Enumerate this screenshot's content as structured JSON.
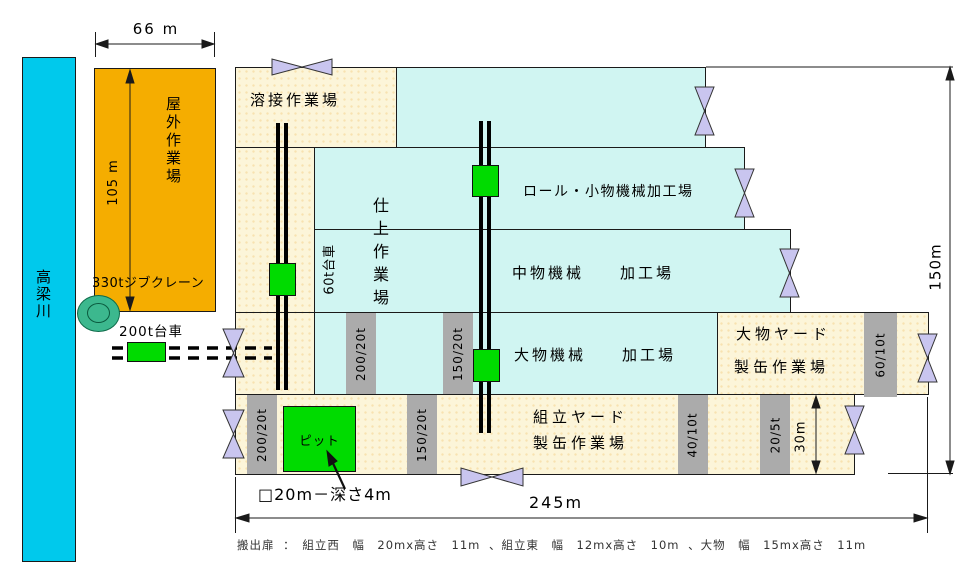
{
  "river": {
    "label": "高梁川"
  },
  "outdoor_yard": {
    "label": "屋外作業場",
    "width_dim": "66 m",
    "height_dim": "105 m"
  },
  "equipment": {
    "jib_crane_label": "330tジブクレーン",
    "cart_200t_label": "200t台車",
    "cart_60t_label": "60t台車",
    "pit_label": "ピット",
    "pit_note": "□20m－深さ4m"
  },
  "areas": {
    "welding": "溶接作業場",
    "finishing": "仕上作業場",
    "roll_small_machine": "ロール・小物機械加工場",
    "medium_machine": "中物機械　　加工場",
    "large_machine": "大物機械　　加工場",
    "large_yard_line1": "大物ヤード",
    "large_yard_line2": "製缶作業場",
    "assembly_yard_line1": "組立ヤード",
    "assembly_yard_line2": "製缶作業場"
  },
  "crane_bars": [
    "200/20t",
    "150/20t",
    "60/10t",
    "200/20t",
    "150/20t",
    "40/10t",
    "20/5t"
  ],
  "dimensions": {
    "total_width": "245m",
    "total_height": "150m",
    "assembly_height": "30m"
  },
  "caption": "搬出扉 ：　組立西　幅　20mx高さ　11m 、組立東　幅　12mx高さ　10m 、大物　幅　15mx高さ　11m",
  "colors": {
    "river": "#00C9EC",
    "outdoor_yard": "#F5AD00",
    "work_area_cream": "#FCF5D9",
    "machine_area_cyan": "#D0F5F2",
    "cart_green": "#00DB00",
    "jib_crane_teal": "#3CB88E",
    "crane_bar_gray": "#ABABAB",
    "door_lavender": "#C9C5EF"
  }
}
